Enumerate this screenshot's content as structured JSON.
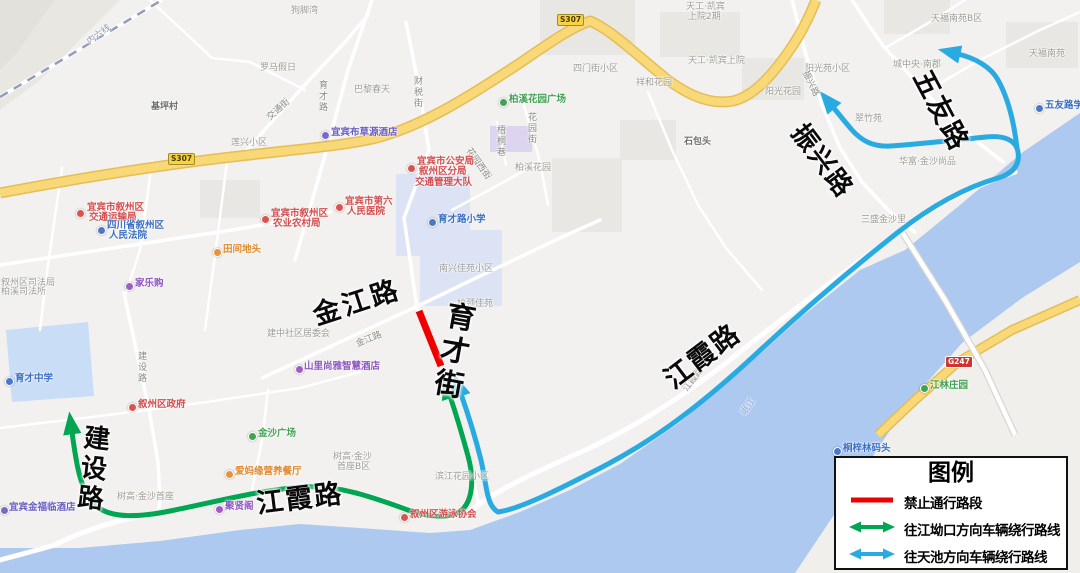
{
  "legend": {
    "title": "图例",
    "items": [
      {
        "label": "禁止通行路段",
        "color": "#ee0000",
        "swatch": "line"
      },
      {
        "label": "往江坳口方向车辆绕行路线",
        "color": "#00a651",
        "swatch": "double-arrow"
      },
      {
        "label": "往天池方向车辆绕行路线",
        "color": "#29abe2",
        "swatch": "double-arrow"
      }
    ]
  },
  "routes": {
    "closed_segment_color": "#ee0000",
    "jiangaokou_route_color": "#00a651",
    "tianchi_route_color": "#29abe2"
  },
  "roads_big": {
    "jinjiang": "金江路",
    "yucai": "育才街",
    "jianshe": "建设路",
    "jiangxia_w": "江霞路",
    "jiangxia_e": "江霞路",
    "zhenxing": "振兴路",
    "wuyou": "五友路"
  },
  "roads_small": {
    "yucai_road": "育才路",
    "caishui": "财税街",
    "jiaotong": "交通街",
    "jinjiang": "金江路",
    "jianshe": "建设路",
    "huayuan": "花园街",
    "wutong": "梧桐巷",
    "huayuanxi": "花园西街",
    "zhenxing": "振兴路",
    "jiangxia": "江霞路"
  },
  "areas": {
    "goujiaowan": "狗脚湾",
    "luoma": "罗马假日",
    "jiping": "基坪村",
    "lianxing": "莲兴小区",
    "bali": "巴黎春天",
    "simenjie": "四门街小区",
    "xianghe": "祥和花园",
    "tiangong1": "天工·凯宾上院",
    "tiangong2a": "天工·凯宾",
    "tiangong2b": "上院2期",
    "yangguang_hy": "阳光花园",
    "yangguang_yuan": "阳光苑小区",
    "chengzhongyang": "城中央·南郡",
    "tianfu_b": "天福南苑B区",
    "tianfu": "天福南苑",
    "cuizhu": "翠竹苑",
    "shibaotou": "石包头",
    "sansheng": "三盛金沙里",
    "huafu": "华富·金沙尚品",
    "nanxing": "南兴佳苑小区",
    "baixi_hy": "柏溪花园",
    "bojing": "柏颈佳苑",
    "jianzhong": "建中社区居委会",
    "shugao1": "树高·金沙首座",
    "shugao2a": "树高·金沙",
    "shugao2b": "首座B区",
    "binjiang": "滨江花园小区",
    "sifa1": "叙州区司法局",
    "sifa2": "柏溪司法所"
  },
  "pois": {
    "jtysj_l1": "宜宾市叙州区",
    "jtysj_l2": "交通运输局",
    "fayuan_l1": "四川省叙州区",
    "fayuan_l2": "人民法院",
    "nyncj_l1": "宜宾市叙州区",
    "nyncj_l2": "农业农村局",
    "gaj_l1": "宜宾市公安局",
    "gaj_l2": "叙州区分局",
    "gaj_l3": "交通管理大队",
    "hosp_l1": "宜宾市第六",
    "hosp_l2": "人民医院",
    "yucai_xx": "育才路小学",
    "tianjian": "田间地头",
    "jialegou": "家乐购",
    "quzhengfu": "叙州区政府",
    "jinsha_gc": "金沙广场",
    "yucai_zx": "育才中学",
    "jinfulin": "宜宾金福临酒店",
    "aima": "爱妈缘营养餐厅",
    "juxiange": "聚贤阁",
    "shanli": "山里尚雅智慧酒店",
    "youyong": "叙州区游泳协会",
    "baixi_gc": "柏溪花园广场",
    "bucao": "宜宾布草源酒店",
    "tongzilin": "桐梓林码头",
    "wuyou_xx": "五友路学校",
    "jianglin": "江林庄园"
  },
  "badges": {
    "s307": "S307",
    "g247": "G247"
  },
  "railway": {
    "label": "内六线"
  },
  "river": {
    "label": "岷江"
  }
}
